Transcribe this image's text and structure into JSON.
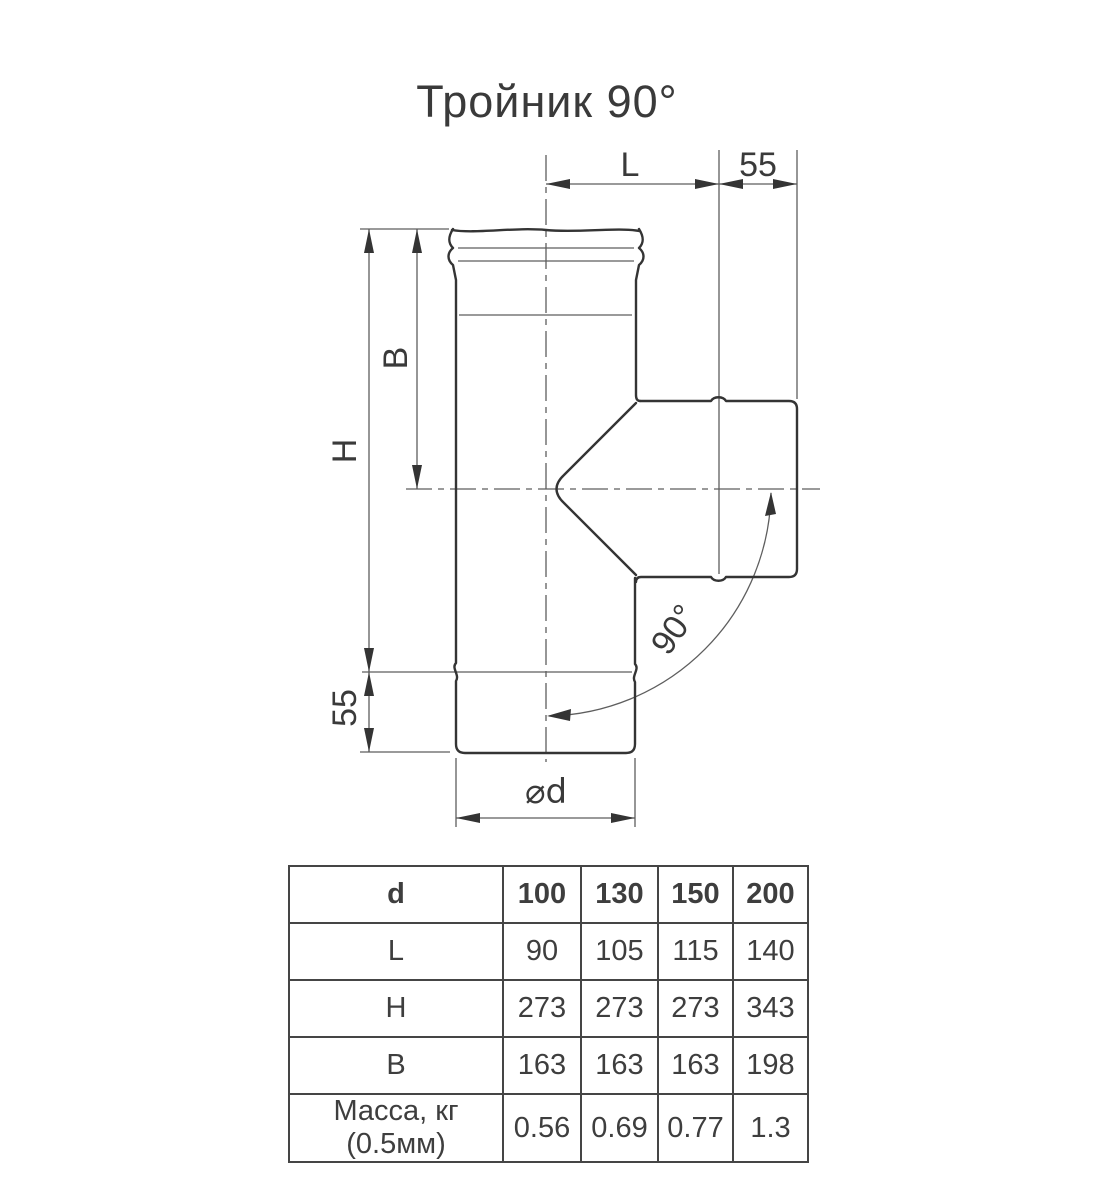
{
  "title": "Тройник 90°",
  "diagram": {
    "dim_top_l": "L",
    "dim_top_55": "55",
    "dim_h": "H",
    "dim_b": "B",
    "dim_left_55": "55",
    "dim_diameter": "⌀d",
    "angle_label": "90°"
  },
  "table": {
    "header": [
      "d",
      "100",
      "130",
      "150",
      "200"
    ],
    "rows": [
      {
        "label": "L",
        "values": [
          "90",
          "105",
          "115",
          "140"
        ]
      },
      {
        "label": "H",
        "values": [
          "273",
          "273",
          "273",
          "343"
        ]
      },
      {
        "label": "B",
        "values": [
          "163",
          "163",
          "163",
          "198"
        ]
      },
      {
        "label": "Масса, кг (0.5мм)",
        "values": [
          "0.56",
          "0.69",
          "0.77",
          "1.3"
        ]
      }
    ]
  },
  "colors": {
    "line": "#343434",
    "thin_line": "#5e5e5e",
    "text": "#3a3a3a",
    "table_border": "#454545",
    "background": "#ffffff"
  }
}
